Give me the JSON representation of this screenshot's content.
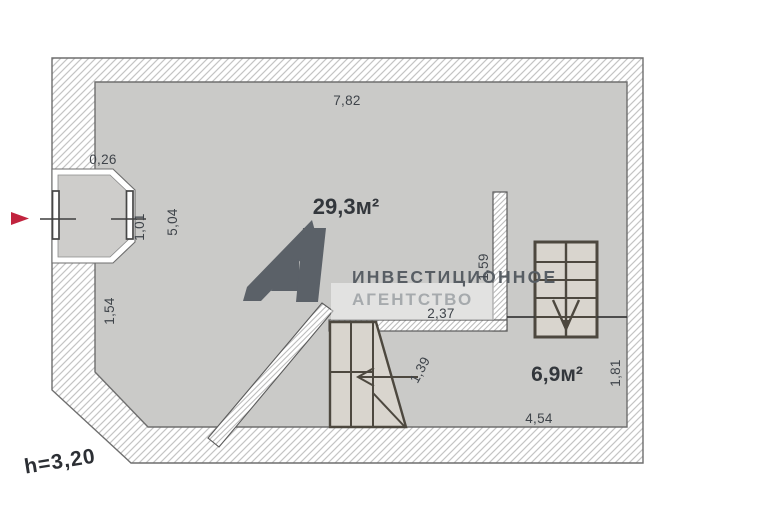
{
  "plan": {
    "height_note": "h=3,20",
    "rooms": [
      {
        "id": "room-large",
        "area_label": "29,3м²"
      },
      {
        "id": "room-small",
        "area_label": "6,9м²"
      }
    ],
    "dimensions": {
      "top_width": "7,82",
      "bay_wall_thickness": "0,26",
      "bay_window_width": "1,01",
      "left_room_depth": "5,04",
      "left_lower_wall": "1,54",
      "inner_wall_length": "1,59",
      "opening_width": "2,37",
      "stair_side": "1,39",
      "small_room_width": "4,54",
      "small_room_depth": "1,81"
    }
  },
  "watermark": {
    "line1": "ИНВЕСТИЦИОННОЕ",
    "line2": "АГЕНТСТВО"
  },
  "colors": {
    "floor": "#cacac8",
    "wall_outline": "#6e6e6e",
    "hatch_line": "#c4c4c4",
    "dimension_text": "#3f444a",
    "area_text": "#33373c",
    "stair_line": "#4d483f",
    "stair_fill": "#d9d5ce",
    "watermark_dark": "#585e64",
    "watermark_light": "#a6aaad",
    "entrance_arrow_red": "#c1233e"
  }
}
